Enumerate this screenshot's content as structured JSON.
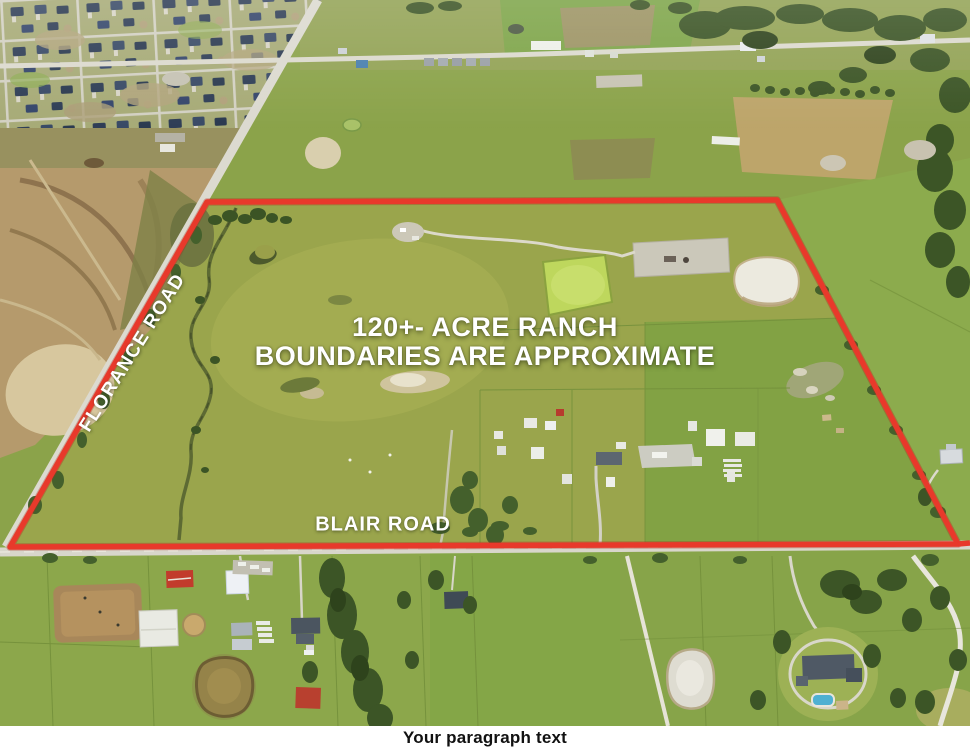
{
  "headline": {
    "line1": "120+- ACRE RANCH",
    "line2": "BOUNDARIES ARE APPROXIMATE"
  },
  "road_labels": {
    "left_road": "FLORANCE ROAD",
    "bottom_road": "BLAIR ROAD"
  },
  "footer": {
    "caption": "Your paragraph text"
  },
  "boundary": {
    "points": "207,202 777,200 958,544 10,547",
    "color": "#e8392b"
  },
  "colors": {
    "boundary_red": "#e8392b",
    "overlay_text": "#ffffff",
    "caption_text": "#111111",
    "caption_background": "#ffffff",
    "pasture_green": "#9aa54c",
    "pond_green": "#bed75d",
    "pool_blue": "#4fb0d2"
  }
}
